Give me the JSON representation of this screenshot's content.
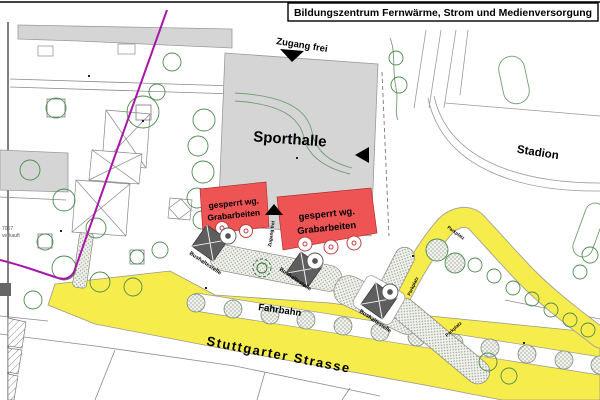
{
  "title": "Bildungszentrum Fernwärme, Strom und Medienversorgung",
  "map": {
    "labels": {
      "zugang_frei": "Zugang frei",
      "sporthalle": "Sporthalle",
      "stadion": "Stadion",
      "gesperrt_line1": "gesperrt wg.",
      "gesperrt_line2": "Grabarbeiten",
      "bushaltestelle": "Bushaltestelle",
      "fahrbahn": "Fahrbahn",
      "strasse": "Stuttgarter Strasse",
      "parkplatz": "Parkplatz",
      "parcel_number": "7067",
      "parcel_status": "verkauft"
    },
    "colors": {
      "road_yellow": "#F6EC4B",
      "closed_red": "#EF5454",
      "boundary_magenta": "#A818A8",
      "building_gray": "#D5D5D5",
      "shelter_gray": "#5E5E5E",
      "tree_green": "#4E8B4E"
    }
  }
}
